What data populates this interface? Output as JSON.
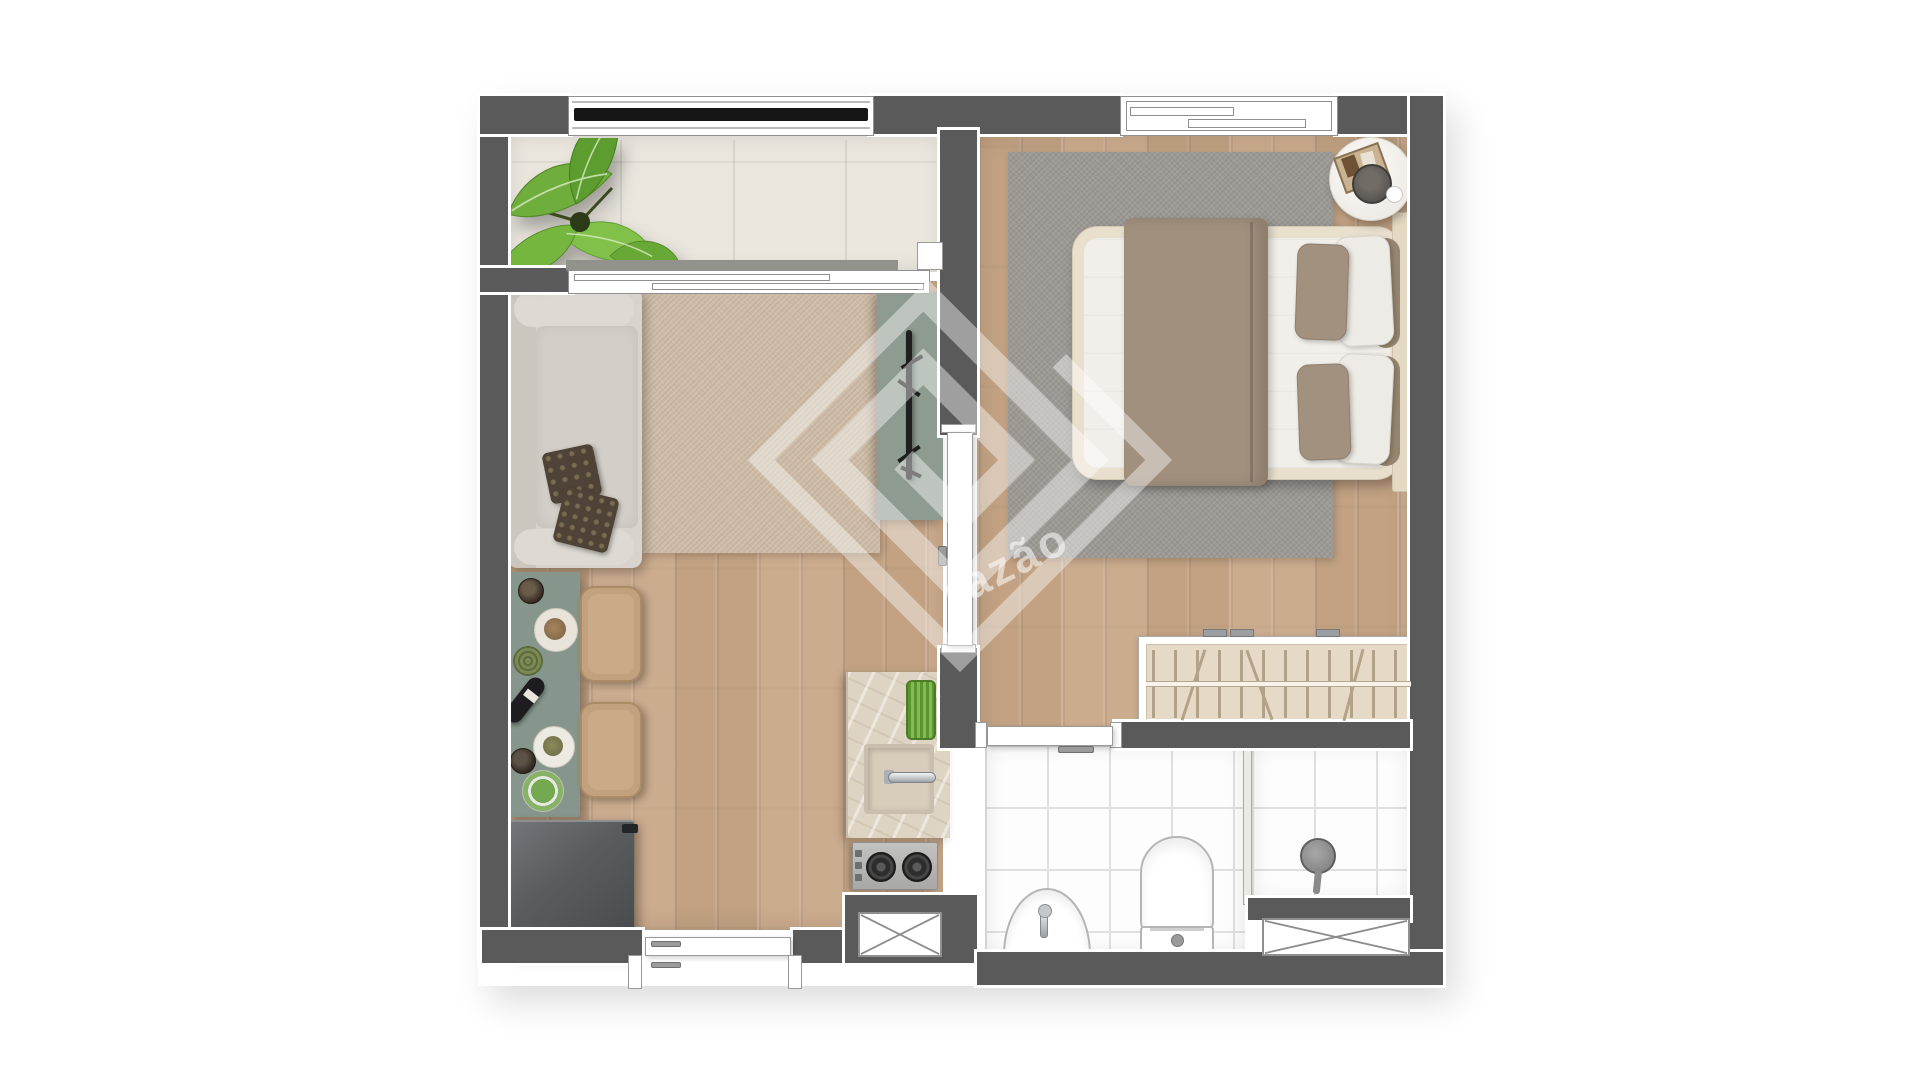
{
  "watermark": {
    "text": "razão",
    "logo": "square-spiral-diamond",
    "color": "rgba(255,255,255,0.55)"
  },
  "palette": {
    "page_bg": "#ffffff",
    "wall": "#5a5a5a",
    "wall_outline": "#ffffff",
    "wood_floor": "#c9a888",
    "balcony_floor": "#eae6de",
    "living_rug": "#cfbda7",
    "bedroom_rug": "#9d9a95",
    "sofa": "#d8d4cd",
    "dark_pillow": "#4e4336",
    "sage_green": "#8d9b90",
    "chair_tan": "#c2a17e",
    "appliance_dark": "#595d60",
    "counter_marble": "#ded4c3",
    "steel": "#b7b7b5",
    "burner": "#2d2d2d",
    "bed_frame": "#e8dfcd",
    "mattress": "#f1efe9",
    "blanket_taupe": "#a2907e",
    "pillow_taupe": "#a3917f",
    "pillow_white": "#edebe5",
    "wardrobe_fill": "#e6dac7",
    "clothes_line": "#b3a28a",
    "tile": "#fdfdfd",
    "tile_line": "#e0e0e0",
    "fixture_outline": "#b5b5b5",
    "plant_green": "#74b63e",
    "plant_green_dark": "#5f9f2f",
    "railing_black": "#161616",
    "watermark": "rgba(255,255,255,0.55)"
  },
  "rooms": {
    "balcony": {
      "items": [
        "potted-plant",
        "sliding-glass-door",
        "railing"
      ]
    },
    "living_room": {
      "items": [
        "sofa",
        "two-throw-pillows",
        "area-rug",
        "tv-panel",
        "tv-stand"
      ]
    },
    "kitchen": {
      "items": [
        "dining-table",
        "dining-chair",
        "dining-chair",
        "refrigerator",
        "counter-with-sink",
        "dish-rack",
        "cooktop",
        "service-duct",
        "entrance-door"
      ]
    },
    "bedroom": {
      "items": [
        "double-bed",
        "area-rug",
        "round-side-table",
        "wardrobe",
        "window",
        "interior-door"
      ]
    },
    "bathroom": {
      "items": [
        "pedestal-sink",
        "toilet",
        "shower",
        "glass-partition",
        "service-duct",
        "door"
      ]
    }
  },
  "counts": {
    "cooktop_burners": 2,
    "dining_chairs": 2,
    "bed_pillows": 4,
    "balcony_floor_seams": 3
  }
}
